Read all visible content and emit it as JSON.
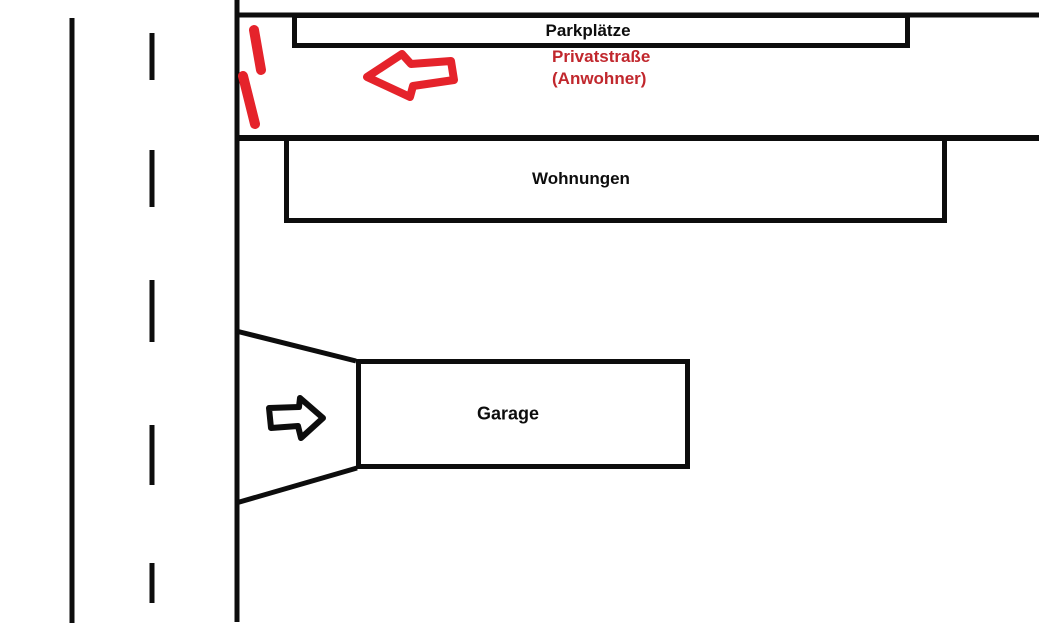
{
  "diagram": {
    "boxes": {
      "parkplaetze": {
        "label": "Parkplätze"
      },
      "wohnungen": {
        "label": "Wohnungen"
      },
      "garage": {
        "label": "Garage"
      }
    },
    "street_label": {
      "line1": "Privatstraße",
      "line2": "(Anwohner)"
    },
    "annotations": {
      "private_road_arrow": "left-arrow-icon",
      "garage_entrance_arrow": "right-arrow-icon",
      "road_closure_marks": "red-dash-marks"
    },
    "colors": {
      "ink": "#0d0d0d",
      "red_stroke": "#e5232b",
      "red_text": "#c1272d",
      "background": "#ffffff"
    }
  }
}
